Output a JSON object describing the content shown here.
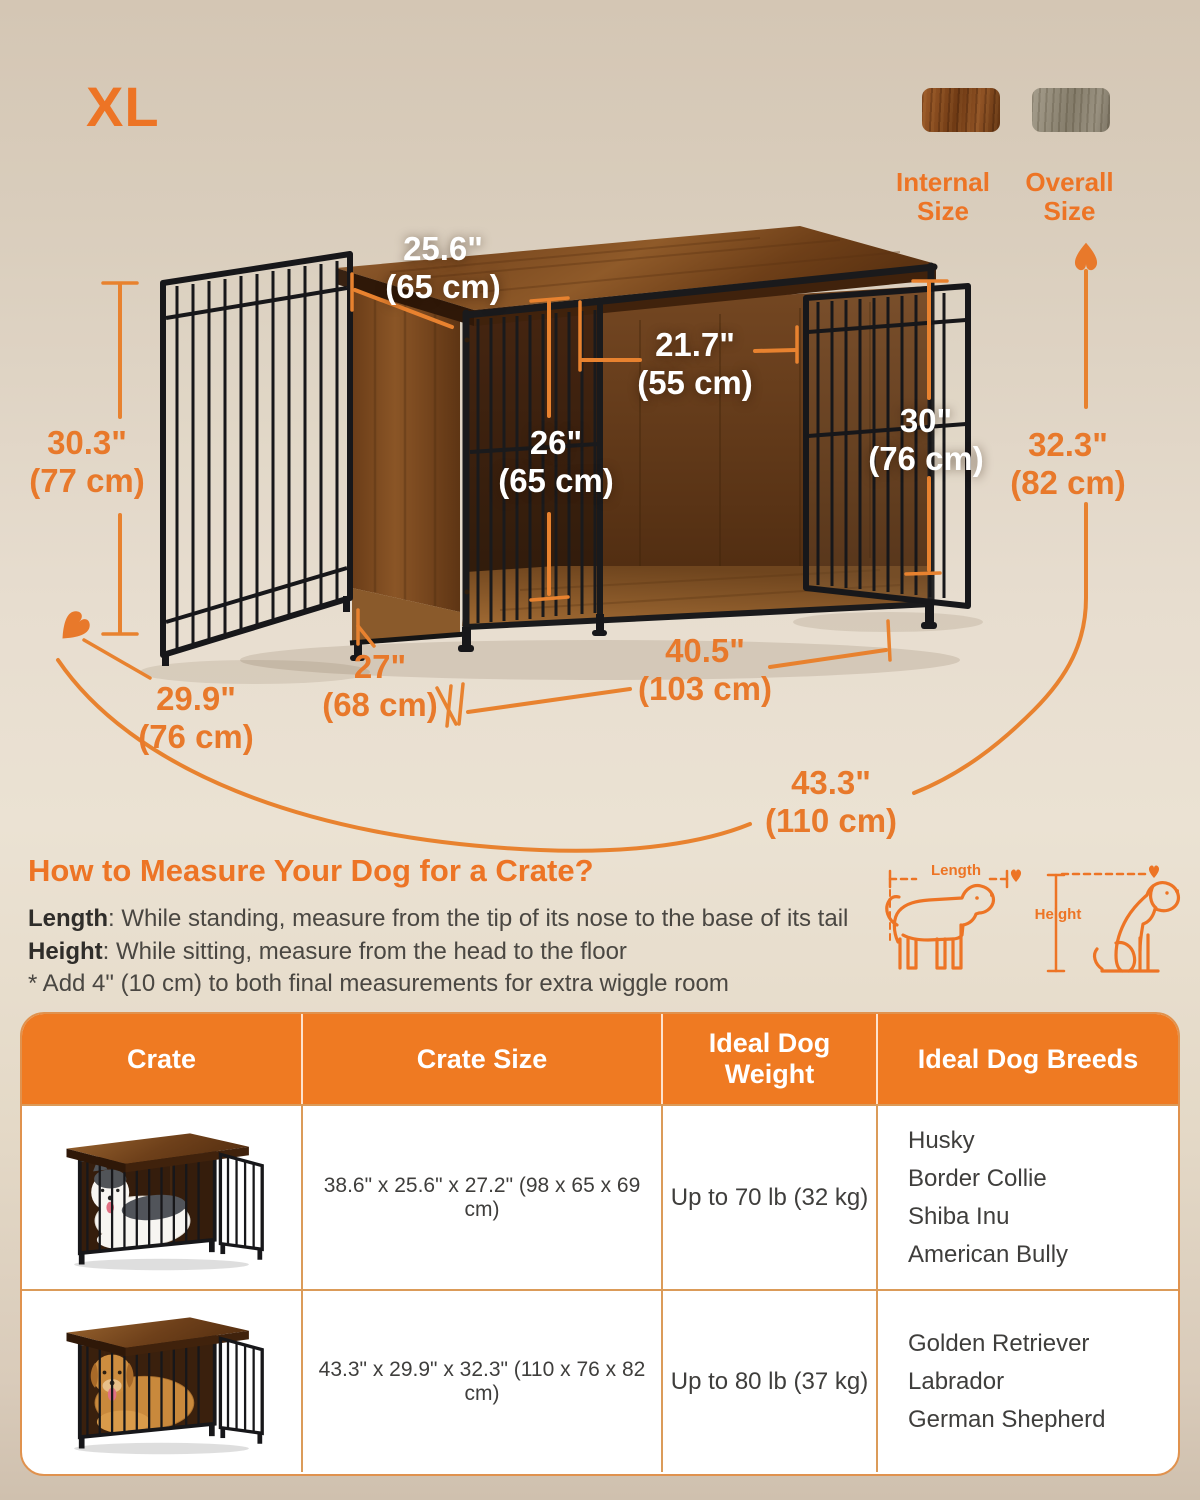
{
  "badge": "XL",
  "legend": {
    "internal_label": "Internal Size",
    "overall_label": "Overall Size"
  },
  "dimensions": {
    "top_depth": {
      "in": "25.6\"",
      "cm": "(65 cm)"
    },
    "door_width": {
      "in": "21.7\"",
      "cm": "(55 cm)"
    },
    "interior_height": {
      "in": "26\"",
      "cm": "(65 cm)"
    },
    "door_height": {
      "in": "30\"",
      "cm": "(76 cm)"
    },
    "side_height": {
      "in": "30.3\"",
      "cm": "(77 cm)"
    },
    "overall_height": {
      "in": "32.3\"",
      "cm": "(82 cm)"
    },
    "interior_depth": {
      "in": "27\"",
      "cm": "(68 cm)"
    },
    "interior_width": {
      "in": "40.5\"",
      "cm": "(103 cm)"
    },
    "overall_depth": {
      "in": "29.9\"",
      "cm": "(76 cm)"
    },
    "overall_width": {
      "in": "43.3\"",
      "cm": "(110 cm)"
    }
  },
  "measure_guide": {
    "title": "How to Measure Your Dog for a Crate?",
    "length_term": "Length",
    "length_desc": ":  While standing, measure from the tip of its nose to the base of its tail",
    "height_term": "Height",
    "height_desc": ": While sitting, measure from the head to the floor",
    "note": "* Add 4\" (10 cm) to both final measurements for extra wiggle room",
    "length_diagram_label": "Length",
    "height_diagram_label": "Height"
  },
  "size_table": {
    "headers": [
      "Crate",
      "Crate Size",
      "Ideal Dog Weight",
      "Ideal Dog Breeds"
    ],
    "rows": [
      {
        "size": "38.6\" x 25.6\" x 27.2\" (98 x 65 x 69 cm)",
        "weight": "Up to 70 lb (32 kg)",
        "breeds": [
          "Husky",
          "Border Collie",
          "Shiba Inu",
          "American Bully"
        ]
      },
      {
        "size": "43.3\" x 29.9\" x 32.3\" (110 x 76 x 82 cm)",
        "weight": "Up to 80 lb (37 kg)",
        "breeds": [
          "Golden Retriever",
          "Labrador",
          "German Shepherd"
        ]
      }
    ]
  },
  "colors": {
    "accent": "#ED7425",
    "dimension_line": "#E8822F",
    "table_header_bg": "#EF7A22",
    "table_border": "#DB9B59",
    "rustic_brown": "#7c4a1e",
    "greige": "#938b79"
  }
}
